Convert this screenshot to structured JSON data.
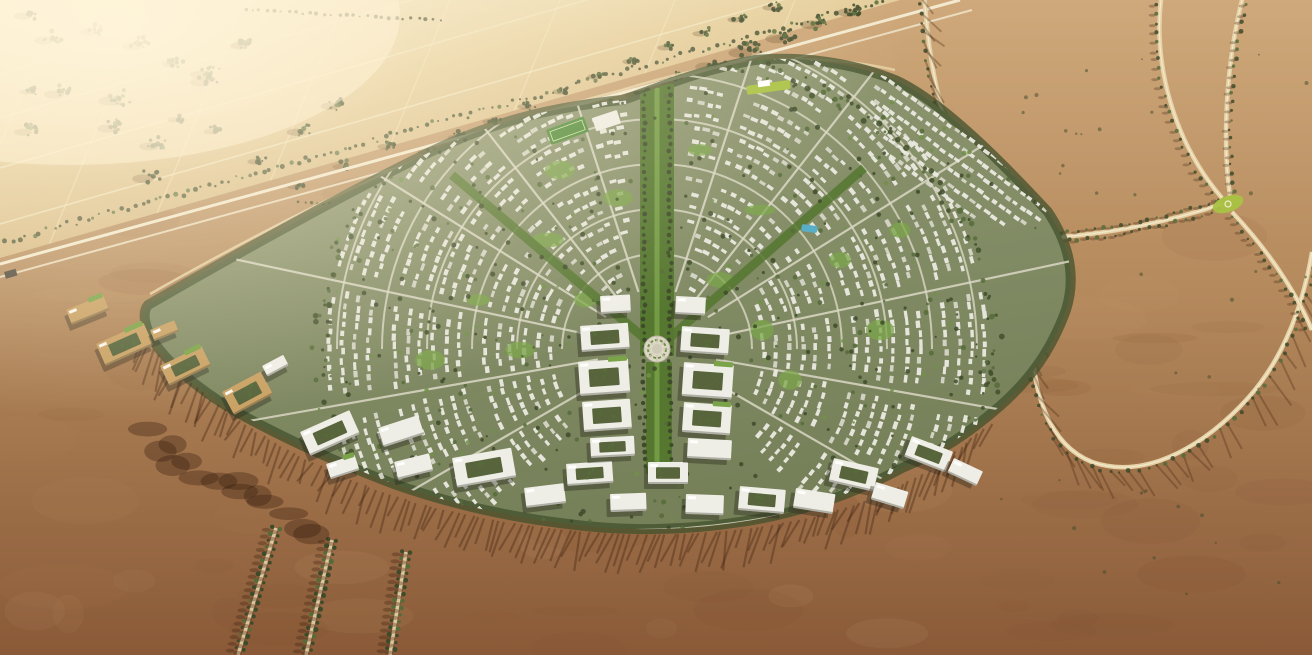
{
  "scene": {
    "type": "aerial-architectural-render",
    "subject": "fan-shaped desert master-plan community surrounded by farmland and desert",
    "regions": [
      {
        "name": "farmland-plain",
        "desc": "sunlit farm parcels with grid roads and tree clusters",
        "color": "#e6cf9e"
      },
      {
        "name": "highway-corridor",
        "desc": "diagonal tree-lined highway separating farmland from development",
        "color": "#f2e9cf"
      },
      {
        "name": "desert-right",
        "desc": "open desert with curving tree-lined parkways",
        "color": "#b4895c"
      },
      {
        "name": "desert-bottom",
        "desc": "dark reddish desert below the community",
        "color": "#8a5a38"
      },
      {
        "name": "master-plan-community",
        "desc": "radial residential fan with green boulevards",
        "color": "#8d9470"
      },
      {
        "name": "office-arc",
        "desc": "arc of large white office blocks along the southern edge",
        "color": "#efeee6"
      },
      {
        "name": "central-green-spine",
        "desc": "central landscaped boulevard",
        "color": "#557730"
      },
      {
        "name": "central-plaza",
        "desc": "circular plaza at the heart of the plan",
        "color": "#ddd8c6"
      }
    ],
    "palette": {
      "farm_glare": "#f7eed0",
      "farm_light": "#e6cf9e",
      "farm_deep": "#cdab76",
      "gridline": "#f2e7c2",
      "tree_dark": "#3e4a2a",
      "tree_mid": "#566b39",
      "tree_light": "#72904a",
      "corridor_road": "#f2e9cf",
      "desert_top": "#cfa97b",
      "desert_mid": "#b4895c",
      "desert_deep": "#8a5a38",
      "mottle_dark": "#7c4c2c",
      "mottle_light": "#c49c6e",
      "road_tan": "#e6d2a6",
      "road_line": "#f3ead0",
      "dev_light": "#929a74",
      "dev_deep": "#76815a",
      "street": "#dbd8c6",
      "house": "#ebeae1",
      "house2": "#d6d6c8",
      "lawn": "#7ba449",
      "boulevard": "#557730",
      "belt": "#42502c",
      "office_white": "#efeee6",
      "office_tan": "#c9a164",
      "courtyard": "#57643c",
      "shadow_dev": "rgba(40,38,26,0.38)",
      "shadow_desert": "rgba(70,40,20,0.38)",
      "plaza": "#ddd8c6",
      "plaza_inner": "#cfcab6",
      "pool": "#58aec6",
      "lime": "#a9c243",
      "field_green": "#4e8a38",
      "glare": "#fff4d8",
      "bridge": "#4a4438"
    },
    "features": {
      "farm_boundary": [
        0,
        258,
        900,
        0
      ],
      "corridor": {
        "road1": "M 0,264 L 960,0",
        "road2": "M 0,277 L 972,10",
        "tree_band": "M 0,246 L 930,-10",
        "bridge": [
          4,
          272,
          12,
          7,
          -16
        ]
      },
      "farm_clusters": [
        [
          30,
          14,
          10,
          9
        ],
        [
          52,
          38,
          12,
          10
        ],
        [
          96,
          30,
          10,
          9
        ],
        [
          140,
          44,
          12,
          10
        ],
        [
          176,
          62,
          10,
          8
        ],
        [
          210,
          72,
          12,
          11
        ],
        [
          246,
          44,
          10,
          9
        ],
        [
          62,
          92,
          12,
          10
        ],
        [
          30,
          130,
          10,
          9
        ],
        [
          115,
          126,
          12,
          10
        ],
        [
          120,
          98,
          14,
          12
        ],
        [
          208,
          80,
          12,
          10
        ],
        [
          247,
          43,
          10,
          9
        ],
        [
          32,
          90,
          8,
          7
        ],
        [
          337,
          104,
          10,
          9
        ],
        [
          303,
          130,
          10,
          9
        ],
        [
          157,
          144,
          12,
          10
        ],
        [
          152,
          176,
          12,
          11
        ],
        [
          216,
          130,
          8,
          7
        ],
        [
          180,
          118,
          8,
          7
        ],
        [
          260,
          160,
          8,
          7
        ],
        [
          300,
          185,
          8,
          7
        ],
        [
          345,
          165,
          8,
          7
        ],
        [
          390,
          145,
          8,
          7
        ],
        [
          335,
          210,
          8,
          7
        ],
        [
          370,
          190,
          6,
          6
        ],
        [
          420,
          170,
          6,
          6
        ],
        [
          300,
          240,
          8,
          8
        ],
        [
          340,
          255,
          8,
          8
        ],
        [
          380,
          235,
          8,
          7
        ],
        [
          420,
          215,
          8,
          7
        ],
        [
          455,
          200,
          8,
          7
        ],
        [
          490,
          185,
          8,
          7
        ],
        [
          520,
          170,
          8,
          7
        ],
        [
          470,
          160,
          16,
          12
        ],
        [
          505,
          148,
          14,
          11
        ],
        [
          540,
          134,
          16,
          12
        ],
        [
          575,
          120,
          14,
          11
        ],
        [
          610,
          106,
          16,
          12
        ],
        [
          645,
          92,
          14,
          11
        ],
        [
          680,
          78,
          16,
          12
        ],
        [
          715,
          64,
          14,
          11
        ],
        [
          750,
          50,
          16,
          12
        ],
        [
          785,
          36,
          14,
          11
        ],
        [
          820,
          22,
          14,
          11
        ],
        [
          855,
          10,
          12,
          10
        ],
        [
          430,
          150,
          8,
          7
        ],
        [
          460,
          136,
          8,
          7
        ],
        [
          495,
          120,
          8,
          7
        ],
        [
          530,
          105,
          8,
          7
        ],
        [
          565,
          90,
          8,
          7
        ],
        [
          600,
          75,
          8,
          7
        ],
        [
          635,
          60,
          8,
          7
        ],
        [
          670,
          46,
          8,
          7
        ],
        [
          705,
          32,
          8,
          7
        ],
        [
          740,
          18,
          8,
          7
        ],
        [
          775,
          6,
          8,
          7
        ]
      ],
      "farm_tree_rows": [
        [
          245,
          10,
          440,
          20,
          7
        ],
        [
          298,
          202,
          435,
          208,
          6
        ]
      ],
      "right_roads": [
        {
          "d": "M 924,-8 C 930,80 946,152 986,196 C 1016,232 1032,282 1032,334 C 1032,392 1048,444 1092,462 C 1150,482 1210,440 1248,398 C 1286,356 1304,300 1312,252",
          "trees": "left",
          "shadow": "downright"
        },
        {
          "d": "M 1162,-8 C 1152,60 1172,140 1222,198",
          "trees": "left",
          "shadow": "left"
        },
        {
          "d": "M 1244,-8 C 1226,60 1222,140 1230,196",
          "trees": "right",
          "shadow": "left"
        },
        {
          "d": "M 1222,204 C 1150,228 1082,238 1008,240",
          "trees": "both",
          "shadow": "left"
        },
        {
          "d": "M 1232,212 C 1268,250 1296,292 1312,330",
          "trees": "left",
          "shadow": "left"
        }
      ],
      "lime_patch": [
        1228,
        204,
        16,
        8,
        -20
      ],
      "sw_avenues": [
        {
          "d": "M 276,528 L 238,655"
        },
        {
          "d": "M 332,540 L 306,655"
        },
        {
          "d": "M 406,552 L 390,655"
        }
      ],
      "dev_blob": "M 148,305 C 240,252 340,196 430,152 C 505,116 565,106 622,100 C 650,92 690,72 755,60 C 800,56 850,62 895,80 C 940,100 1000,160 1048,212 C 1070,245 1076,278 1066,310 C 1052,348 1032,378 1000,406 C 968,434 940,452 902,468 C 858,492 798,514 740,522 C 688,530 628,532 568,524 C 508,517 448,503 394,484 C 338,463 284,438 240,414 C 202,392 170,366 154,342 C 144,326 142,312 148,305 Z",
      "dev_edge_road": "M 150,300 C 300,215 450,140 622,96 C 700,72 790,52 895,76",
      "bottom_arc": "M 140,330 C 200,400 300,465 420,500 C 530,528 640,538 745,525 C 850,512 930,478 990,420",
      "inner_arc_street": "M 180,392 C 290,470 420,515 570,528 C 680,537 800,522 900,478",
      "offices": [
        [
          66,
          310,
          40,
          16,
          -22,
          "tan",
          0,
          1
        ],
        [
          96,
          344,
          52,
          24,
          -24,
          "tan",
          1,
          1
        ],
        [
          150,
          330,
          26,
          12,
          -22,
          "tan",
          0,
          0
        ],
        [
          160,
          366,
          46,
          22,
          -26,
          "tan",
          1,
          1
        ],
        [
          222,
          392,
          44,
          26,
          -28,
          "tan",
          1,
          0
        ],
        [
          262,
          366,
          24,
          12,
          -28,
          "white",
          0,
          0
        ],
        [
          300,
          432,
          54,
          26,
          -24,
          "white",
          1,
          0
        ],
        [
          378,
          428,
          42,
          20,
          -18,
          "white",
          0,
          0
        ],
        [
          326,
          464,
          30,
          16,
          -18,
          "white",
          0,
          1
        ],
        [
          394,
          462,
          36,
          18,
          -14,
          "white",
          0,
          0
        ],
        [
          452,
          458,
          60,
          30,
          -10,
          "white",
          1,
          0
        ],
        [
          524,
          488,
          40,
          20,
          -7,
          "white",
          0,
          0
        ],
        [
          566,
          464,
          46,
          22,
          -4,
          "white",
          1,
          0
        ],
        [
          610,
          494,
          36,
          18,
          -2,
          "white",
          0,
          0
        ],
        [
          648,
          462,
          40,
          22,
          0,
          "white",
          1,
          0
        ],
        [
          686,
          494,
          38,
          20,
          2,
          "white",
          0,
          0
        ],
        [
          740,
          486,
          46,
          24,
          5,
          "white",
          1,
          0
        ],
        [
          796,
          488,
          40,
          20,
          9,
          "white",
          0,
          0
        ],
        [
          834,
          458,
          46,
          24,
          13,
          "white",
          1,
          0
        ],
        [
          876,
          482,
          34,
          18,
          17,
          "white",
          0,
          0
        ],
        [
          912,
          436,
          44,
          22,
          21,
          "white",
          1,
          0
        ],
        [
          954,
          458,
          32,
          16,
          25,
          "white",
          0,
          0
        ]
      ],
      "town_blocks": [
        [
          600,
          296,
          30,
          18,
          -3,
          "white",
          0,
          0
        ],
        [
          676,
          296,
          30,
          18,
          3,
          "white",
          0,
          0
        ],
        [
          580,
          326,
          48,
          26,
          -4,
          "white",
          1,
          0
        ],
        [
          682,
          326,
          48,
          26,
          4,
          "white",
          1,
          0
        ],
        [
          578,
          362,
          50,
          34,
          -4,
          "white",
          1,
          1
        ],
        [
          684,
          362,
          50,
          34,
          4,
          "white",
          1,
          1
        ],
        [
          582,
          402,
          48,
          30,
          -4,
          "white",
          1,
          0
        ],
        [
          684,
          402,
          48,
          30,
          4,
          "white",
          1,
          1
        ],
        [
          590,
          438,
          44,
          20,
          -3,
          "white",
          1,
          0
        ],
        [
          688,
          438,
          44,
          20,
          3,
          "white",
          0,
          0
        ]
      ],
      "landmarks": {
        "sports_field": [
          546,
          130,
          40,
          16,
          -20
        ],
        "sports_hall": [
          592,
          118,
          26,
          14,
          -18
        ],
        "pool": [
          802,
          224,
          16,
          7,
          8
        ],
        "lime_strip": [
          746,
          86,
          44,
          9,
          -8
        ],
        "plaza_center": [
          657,
          349
        ]
      }
    }
  }
}
